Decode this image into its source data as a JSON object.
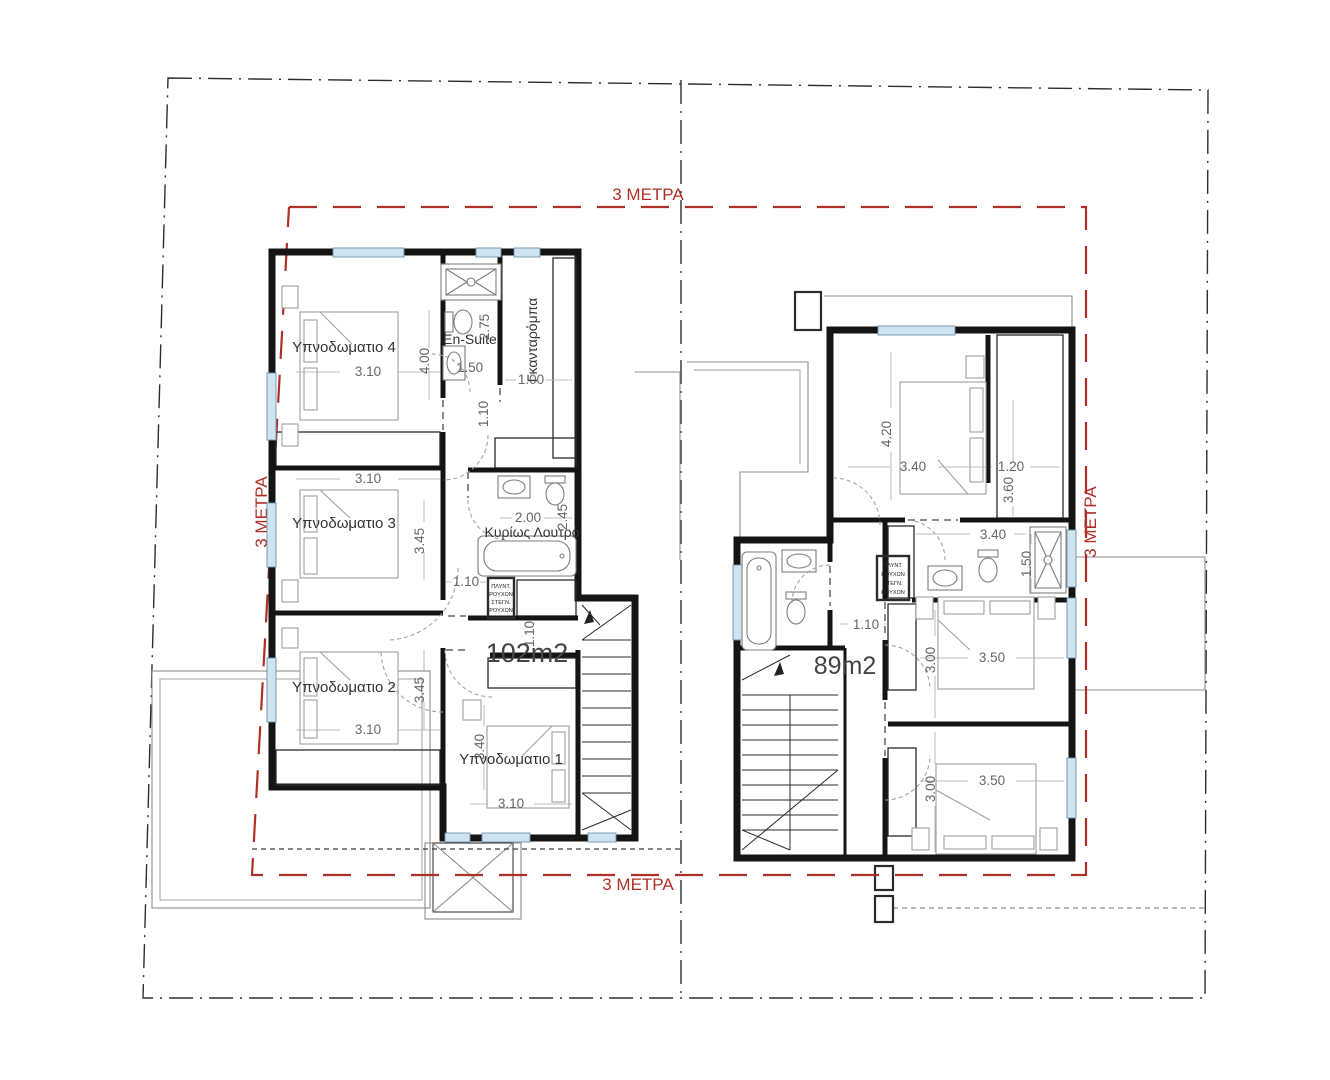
{
  "drawing": {
    "plot": {
      "top_label": "3 ΜΕΤΡΑ",
      "left_label": "3 ΜΕΤΡΑ",
      "right_label": "3 ΜΕΤΡΑ",
      "bottom_label": "3 ΜΕΤΡΑ",
      "setback_color": "#b03028"
    },
    "left_unit": {
      "area": "102m2",
      "bedroom4": {
        "name": "Υπνοδωματιο 4",
        "w": "3.10",
        "h": "4.00"
      },
      "bedroom3": {
        "name": "Υπνοδωματιο 3",
        "w": "3.10",
        "h": "3.45"
      },
      "bedroom2": {
        "name": "Υπνοδωματιο 2",
        "w": "3.10",
        "h": "3.45"
      },
      "bedroom1": {
        "name": "Υπνοδωματιο 1",
        "w": "3.10",
        "h": "3.40"
      },
      "ensuite": {
        "name": "En-Suite",
        "w": "1.50",
        "h": "2.75",
        "door": "1.10"
      },
      "wardrobe": {
        "name": "Γκανταρόμπα",
        "w": "1.00"
      },
      "main_bath": {
        "name": "Κυρίως Λουτρό",
        "w": "2.00",
        "h": "2.45"
      },
      "hall": {
        "door_w": "1.10",
        "passage": "1.10"
      },
      "laundry": {
        "l1": "ΠΛΥΝΤ.",
        "l2": "ΡΟΥΧΩΝ",
        "l3": "ΣΤΕΓΝ.",
        "l4": "ΡΟΥΧΩΝ"
      }
    },
    "right_unit": {
      "area": "89m2",
      "bedroom_top": {
        "w": "3.40",
        "h": "4.20"
      },
      "wardrobe_top": {
        "w": "1.20",
        "h": "3.60"
      },
      "bath": {
        "w": "3.40",
        "h": "1.50"
      },
      "bedroom_mid": {
        "w": "3.50",
        "h": "3.00"
      },
      "bedroom_low": {
        "w": "3.50",
        "h": "3.00"
      },
      "hall": {
        "passage": "1.10"
      },
      "laundry": {
        "l1": "ΠΛΥΝΤ.",
        "l2": "ΡΟΥΧΩΝ",
        "l3": "ΣΤΕΓΝ.",
        "l4": "ΡΟΥΧΩΝ"
      }
    }
  }
}
